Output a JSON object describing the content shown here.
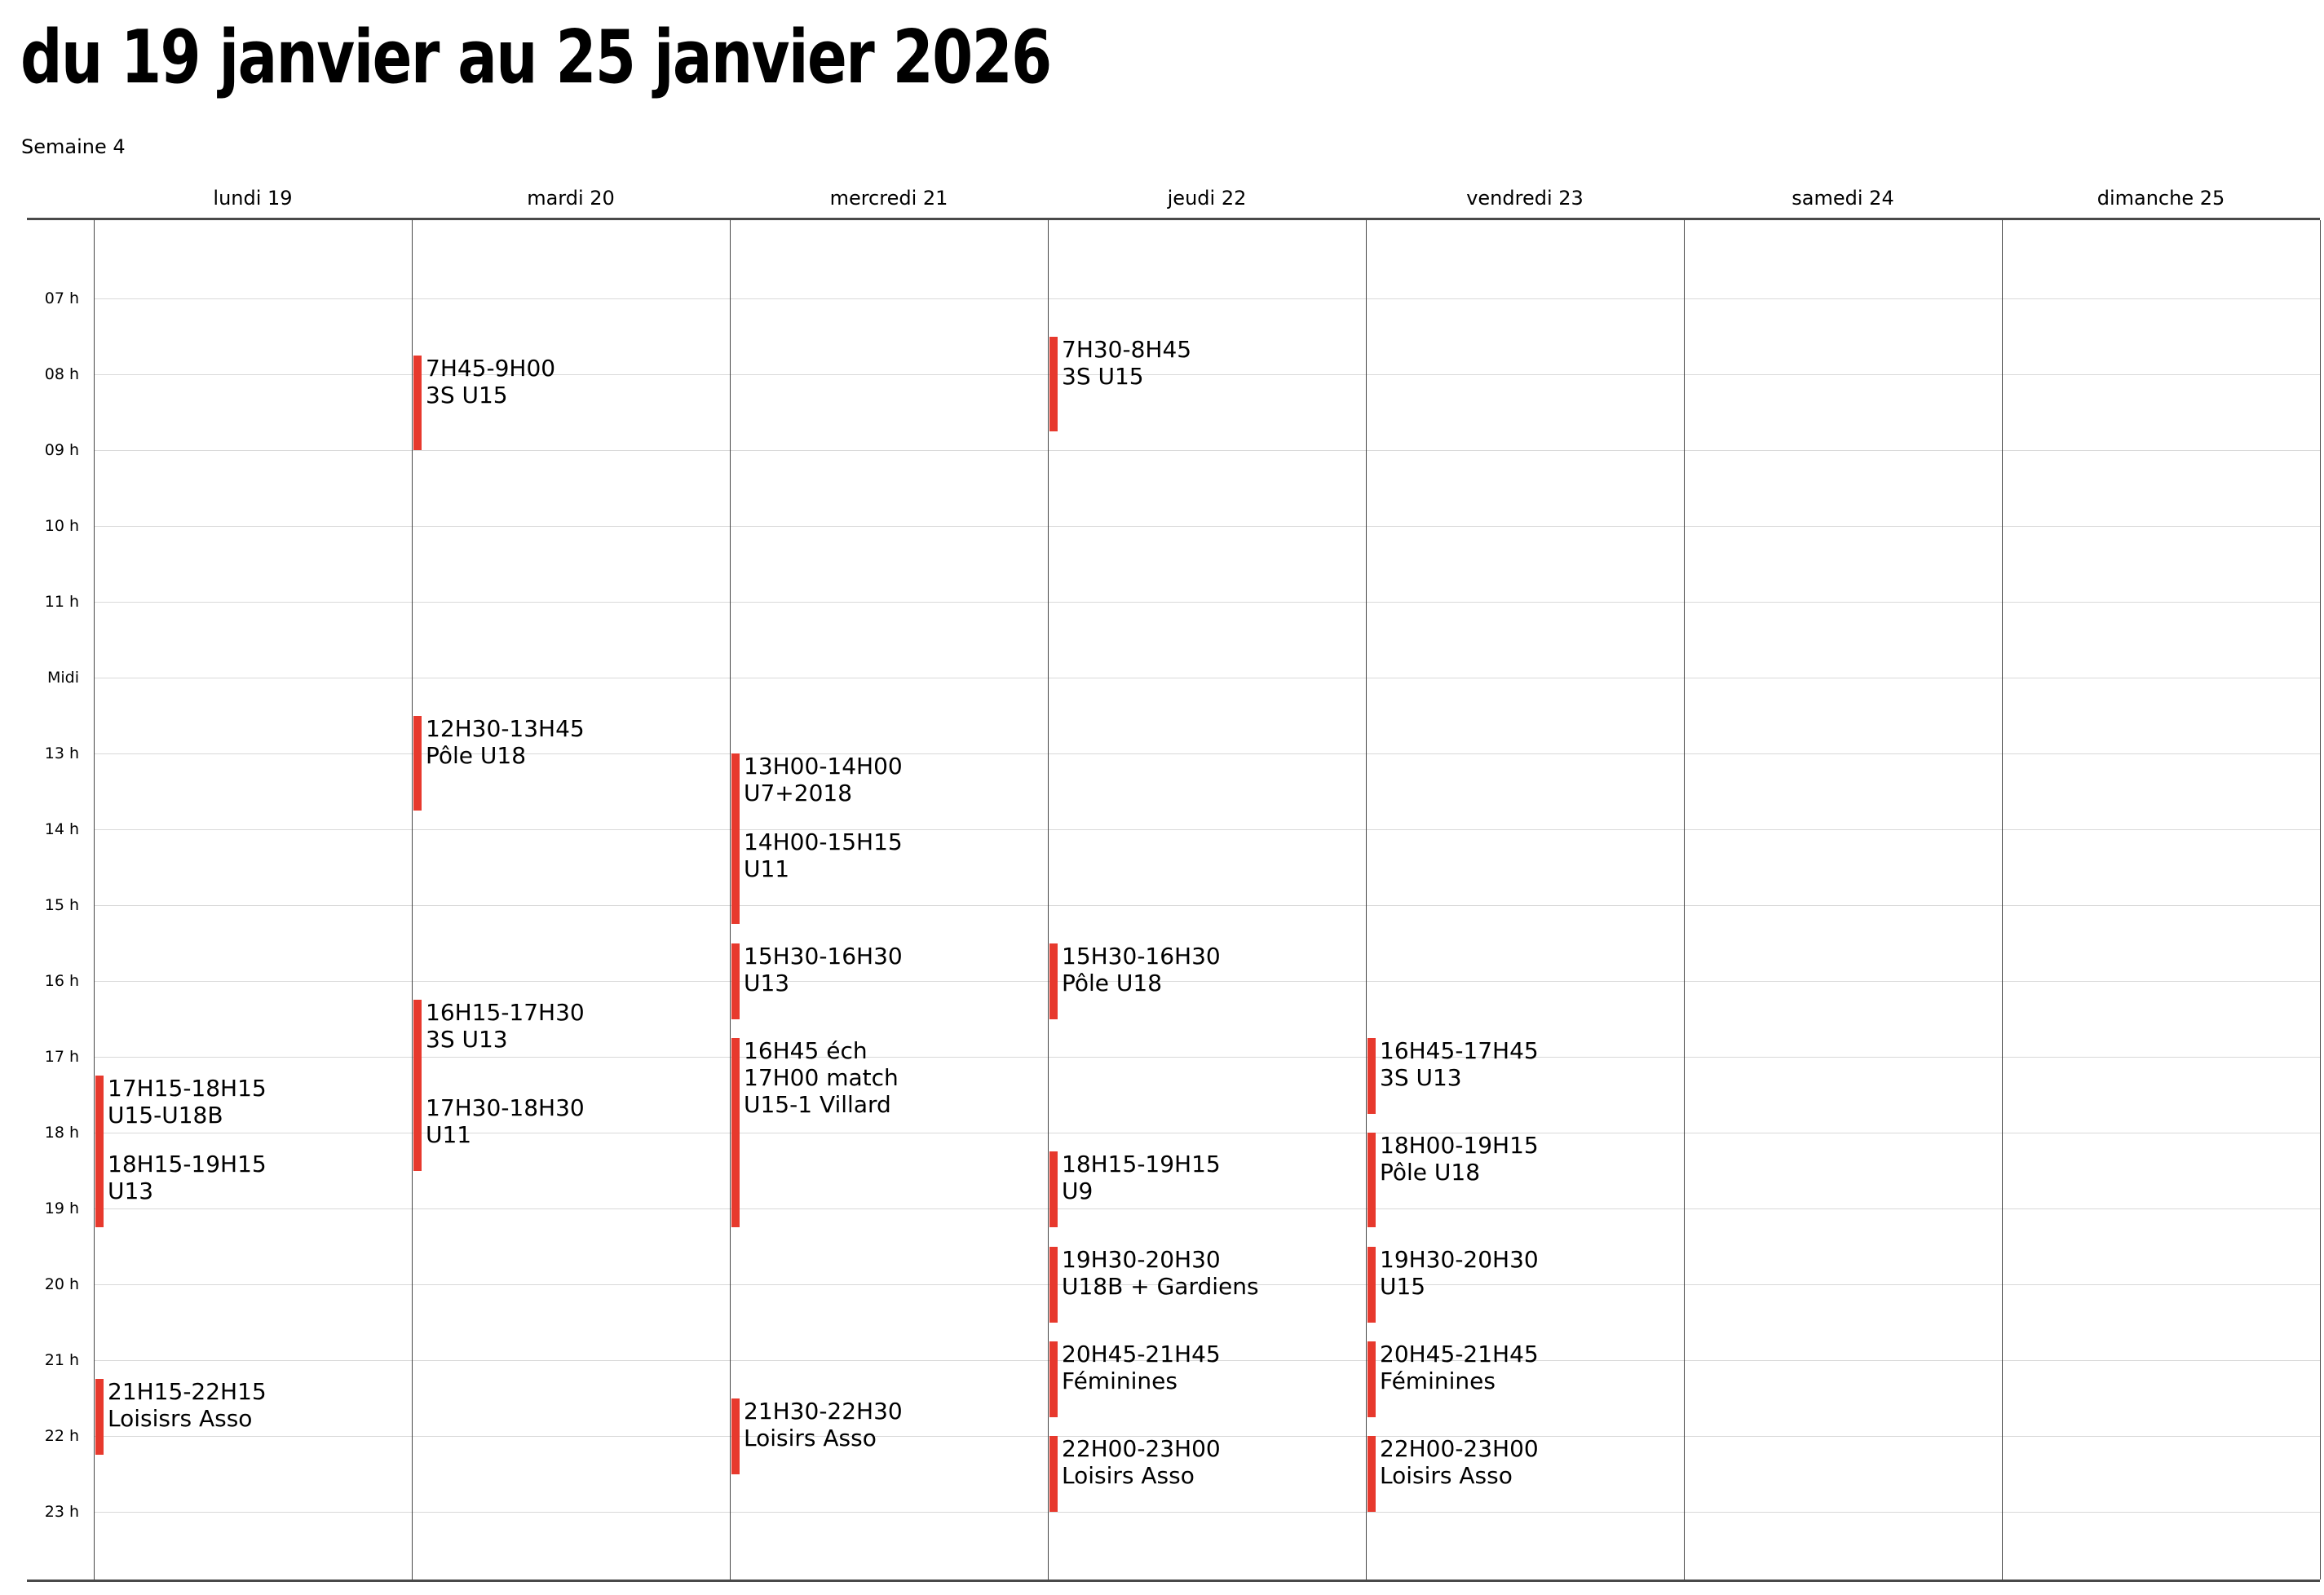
{
  "header": {
    "title": "du 19 janvier au 25 janvier 2026",
    "subtitle": "Semaine 4"
  },
  "calendar": {
    "hours": [
      "07 h",
      "08 h",
      "09 h",
      "10 h",
      "11 h",
      "Midi",
      "13 h",
      "14 h",
      "15 h",
      "16 h",
      "17 h",
      "18 h",
      "19 h",
      "20 h",
      "21 h",
      "22 h",
      "23 h"
    ],
    "colors": {
      "event_bar": "#e7392d",
      "grid_border": "#4a4a4a",
      "column_divider": "#474747",
      "hour_line": "#d9d9d9"
    },
    "days": [
      {
        "label": "lundi 19",
        "events": [
          {
            "lines": [
              "17H15-18H15",
              "U15-U18B"
            ],
            "start": 17.25,
            "end": 18.25
          },
          {
            "lines": [
              "18H15-19H15",
              "U13"
            ],
            "start": 18.25,
            "end": 19.25
          },
          {
            "lines": [
              "21H15-22H15",
              "Loisisrs Asso"
            ],
            "start": 21.25,
            "end": 22.25
          }
        ]
      },
      {
        "label": "mardi 20",
        "events": [
          {
            "lines": [
              "7H45-9H00",
              "3S U15"
            ],
            "start": 7.75,
            "end": 9.0
          },
          {
            "lines": [
              "12H30-13H45",
              "Pôle U18"
            ],
            "start": 12.5,
            "end": 13.75
          },
          {
            "lines": [
              "16H15-17H30",
              "3S U13"
            ],
            "start": 16.25,
            "end": 17.5
          },
          {
            "lines": [
              "17H30-18H30",
              "U11"
            ],
            "start": 17.5,
            "end": 18.5
          }
        ]
      },
      {
        "label": "mercredi 21",
        "events": [
          {
            "lines": [
              "13H00-14H00",
              "U7+2018"
            ],
            "start": 13.0,
            "end": 14.0
          },
          {
            "lines": [
              "14H00-15H15",
              "U11"
            ],
            "start": 14.0,
            "end": 15.25
          },
          {
            "lines": [
              "15H30-16H30",
              "U13"
            ],
            "start": 15.5,
            "end": 16.5
          },
          {
            "lines": [
              "16H45 éch",
              "17H00 match",
              "U15-1 Villard"
            ],
            "start": 16.75,
            "end": 19.25
          },
          {
            "lines": [
              "21H30-22H30",
              "Loisirs Asso"
            ],
            "start": 21.5,
            "end": 22.5
          }
        ]
      },
      {
        "label": "jeudi 22",
        "events": [
          {
            "lines": [
              "7H30-8H45",
              "3S U15"
            ],
            "start": 7.5,
            "end": 8.75
          },
          {
            "lines": [
              "15H30-16H30",
              "Pôle U18"
            ],
            "start": 15.5,
            "end": 16.5
          },
          {
            "lines": [
              "18H15-19H15",
              "U9"
            ],
            "start": 18.25,
            "end": 19.25
          },
          {
            "lines": [
              "19H30-20H30",
              "U18B + Gardiens"
            ],
            "start": 19.5,
            "end": 20.5
          },
          {
            "lines": [
              "20H45-21H45",
              "Féminines"
            ],
            "start": 20.75,
            "end": 21.75
          },
          {
            "lines": [
              "22H00-23H00",
              "Loisirs Asso"
            ],
            "start": 22.0,
            "end": 23.0
          }
        ]
      },
      {
        "label": "vendredi 23",
        "events": [
          {
            "lines": [
              "16H45-17H45",
              "3S U13"
            ],
            "start": 16.75,
            "end": 17.75
          },
          {
            "lines": [
              "18H00-19H15",
              "Pôle U18"
            ],
            "start": 18.0,
            "end": 19.25
          },
          {
            "lines": [
              "19H30-20H30",
              "U15"
            ],
            "start": 19.5,
            "end": 20.5
          },
          {
            "lines": [
              "20H45-21H45",
              "Féminines"
            ],
            "start": 20.75,
            "end": 21.75
          },
          {
            "lines": [
              "22H00-23H00",
              "Loisirs Asso"
            ],
            "start": 22.0,
            "end": 23.0
          }
        ]
      },
      {
        "label": "samedi 24",
        "events": []
      },
      {
        "label": "dimanche 25",
        "events": []
      }
    ]
  }
}
